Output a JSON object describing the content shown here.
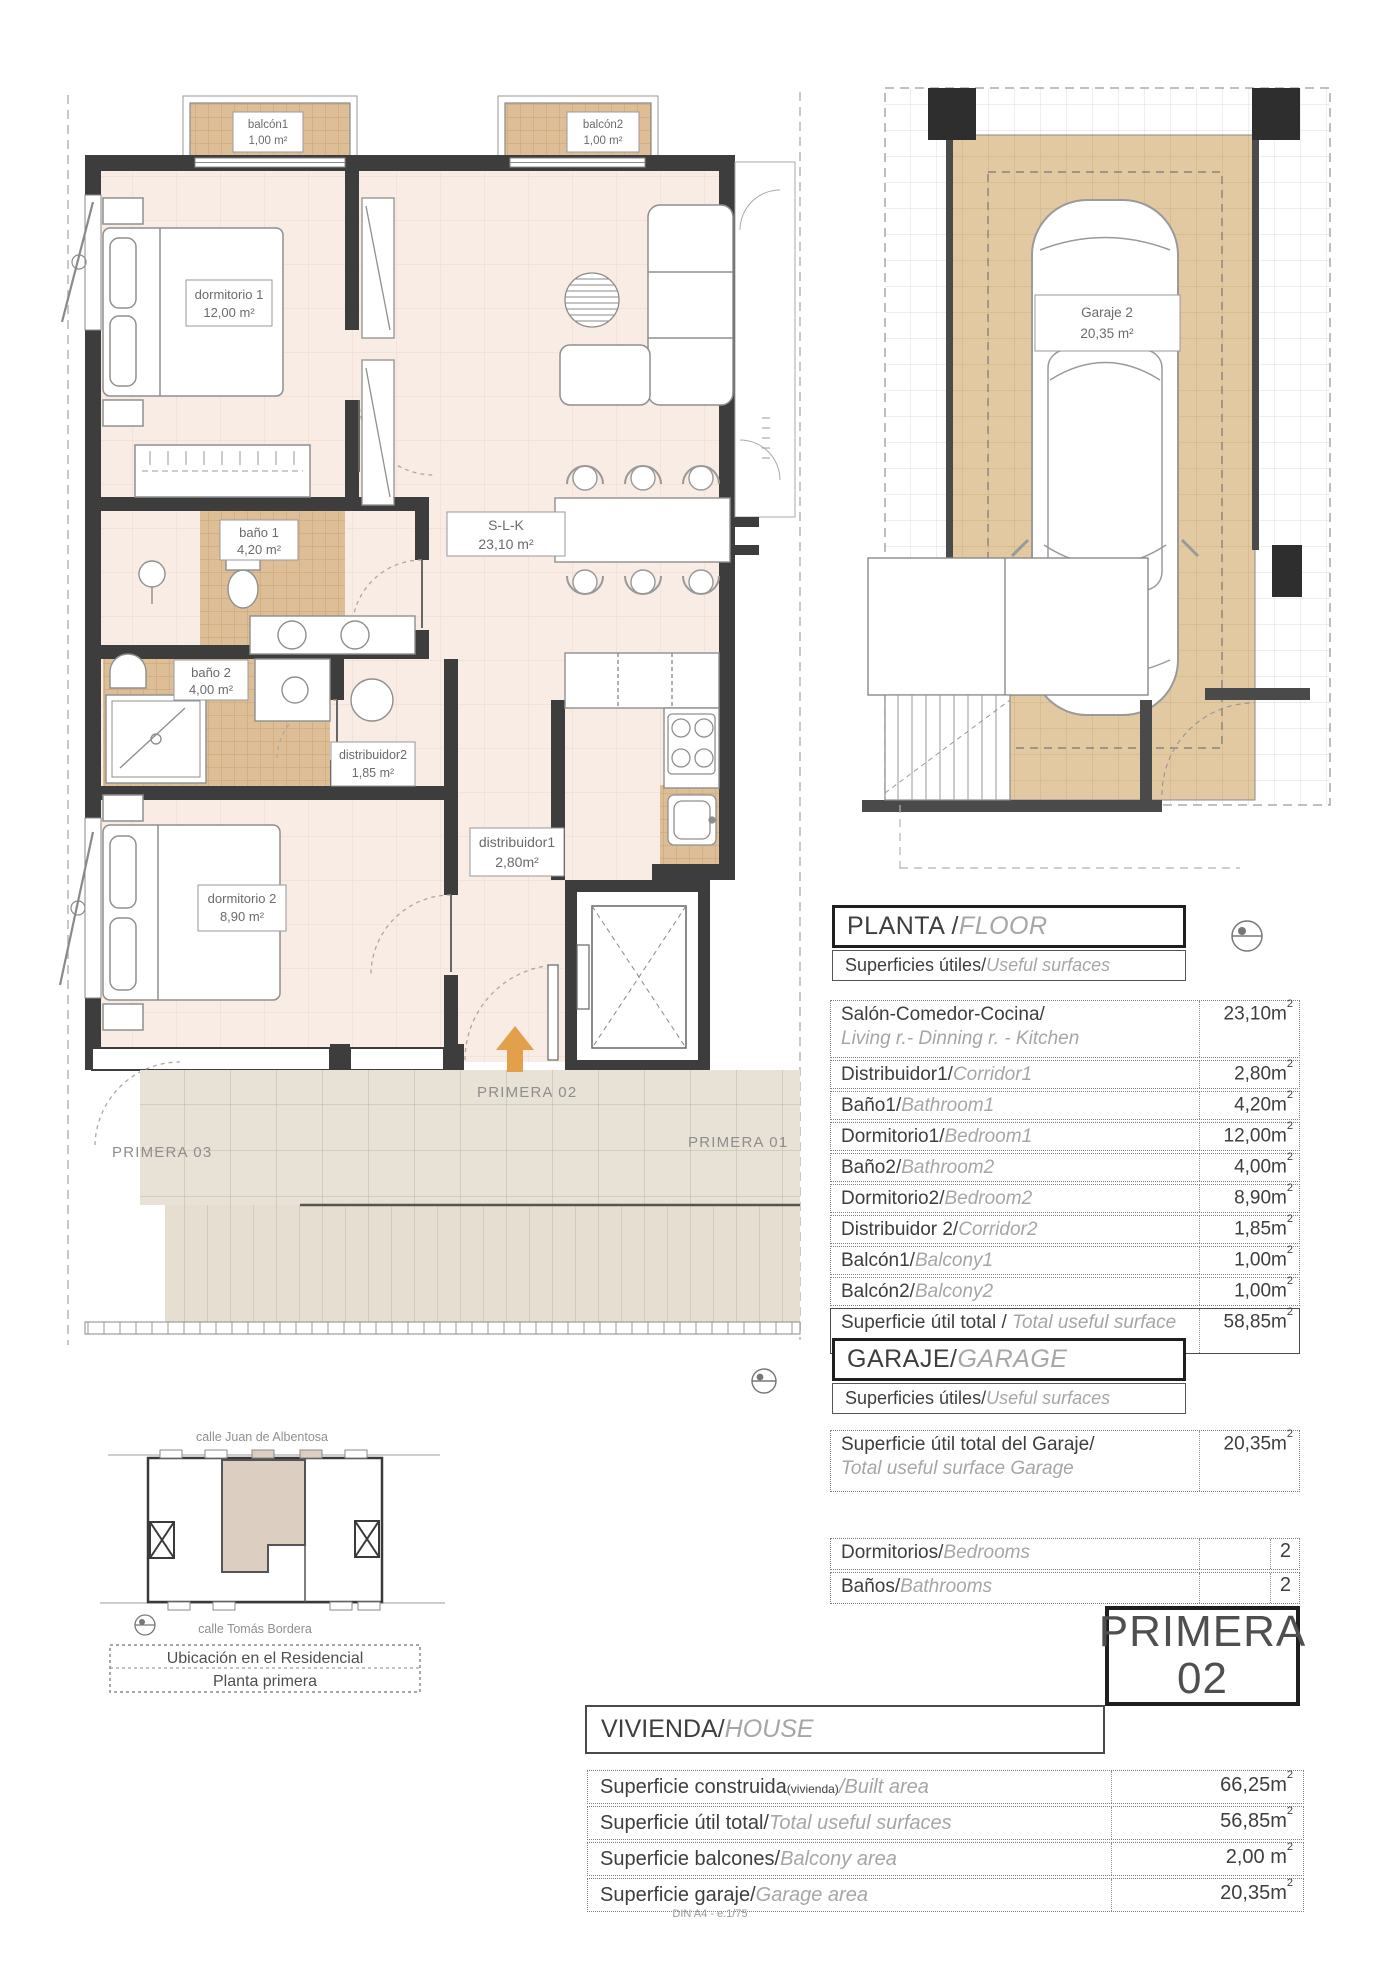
{
  "colors": {
    "accent_orange": "#E2A04A",
    "tile_tan": "#DEBE97",
    "floor_pink": "#F8ECE4",
    "terrace": "#E8E1D5",
    "garage_tan": "#E3C9A1",
    "highlight_unit": "#DCCFC2",
    "wall": "#3D3D3D"
  },
  "floor_plan": {
    "rooms": {
      "balcon1": {
        "name": "balcón1",
        "area": "1,00 m²"
      },
      "balcon2": {
        "name": "balcón2",
        "area": "1,00 m²"
      },
      "dorm1": {
        "name": "dormitorio 1",
        "area": "12,00 m²"
      },
      "bano1": {
        "name": "baño 1",
        "area": "4,20 m²"
      },
      "slk": {
        "name": "S-L-K",
        "area": "23,10 m²"
      },
      "bano2": {
        "name": "baño 2",
        "area": "4,00 m²"
      },
      "distr2": {
        "name": "distribuidor2",
        "area": "1,85 m²"
      },
      "distr1": {
        "name": "distribuidor1",
        "area": "2,80m²"
      },
      "dorm2": {
        "name": "dormitorio 2",
        "area": "8,90 m²"
      }
    },
    "annotations": {
      "primera02": "PRIMERA 02",
      "primera03": "PRIMERA 03",
      "primera01": "PRIMERA 01"
    }
  },
  "garage_plan": {
    "name": "Garaje 2",
    "area": "20,35 m²"
  },
  "floor_table": {
    "title_es": "PLANTA / ",
    "title_en": "FLOOR",
    "subtitle_es": "Superficies útiles/",
    "subtitle_en": "Useful surfaces",
    "rows": [
      {
        "es": "Salón-Comedor-Cocina/",
        "en": "Living r.- Dinning r. - Kitchen",
        "value": "23,10m",
        "sup": "2"
      },
      {
        "es": "Distribuidor1/",
        "en": "Corridor1",
        "value": "2,80m",
        "sup": "2"
      },
      {
        "es": "Baño1/",
        "en": "Bathroom1",
        "value": "4,20m",
        "sup": "2"
      },
      {
        "es": "Dormitorio1/",
        "en": "Bedroom1",
        "value": "12,00m",
        "sup": "2"
      },
      {
        "es": "Baño2/",
        "en": "Bathroom2",
        "value": "4,00m",
        "sup": "2"
      },
      {
        "es": "Dormitorio2/",
        "en": "Bedroom2",
        "value": "8,90m",
        "sup": "2"
      },
      {
        "es": "Distribuidor 2/",
        "en": "Corridor2",
        "value": "1,85m",
        "sup": "2"
      },
      {
        "es": "Balcón1/",
        "en": "Balcony1",
        "value": "1,00m",
        "sup": "2"
      },
      {
        "es": "Balcón2/",
        "en": "Balcony2",
        "value": "1,00m",
        "sup": "2"
      }
    ],
    "total": {
      "es": "Superficie útil total / ",
      "en": "Total useful surface",
      "value": "58,85m",
      "sup": "2"
    }
  },
  "garage_table": {
    "title_es": "GARAJE/",
    "title_en": "GARAGE",
    "subtitle_es": "Superficies útiles/",
    "subtitle_en": "Useful surfaces",
    "row": {
      "es": "Superficie útil total del Garaje/",
      "en": "Total useful surface Garage",
      "value": "20,35m",
      "sup": "2"
    }
  },
  "counts_table": {
    "rows": [
      {
        "es": "Dormitorios/",
        "en": "Bedrooms",
        "value": "2"
      },
      {
        "es": "Baños/",
        "en": "Bathrooms",
        "value": "2"
      }
    ]
  },
  "unit_badge": {
    "line1": "PRIMERA",
    "line2": "02"
  },
  "house_table": {
    "title_es": "VIVIENDA/",
    "title_en": "HOUSE",
    "rows": [
      {
        "es": "Superficie construida",
        "small": "(vivienda)",
        "en": "/Built area",
        "value": "66,25m",
        "sup": "2"
      },
      {
        "es": "Superficie útil total/",
        "en": "Total useful surfaces",
        "value": "56,85m",
        "sup": "2"
      },
      {
        "es": "Superficie balcones/",
        "en": "Balcony area",
        "value": "2,00 m",
        "sup": "2"
      },
      {
        "es": "Superficie garaje/",
        "en": "Garage area",
        "value": "20,35m",
        "sup": "2"
      }
    ]
  },
  "location_plan": {
    "street_top": "calle Juan de Albentosa",
    "street_bottom": "calle Tomás Bordera",
    "caption_line1": "Ubicación en el Residencial",
    "caption_line2": "Planta primera"
  },
  "footer": "DIN A4 - e.1/75"
}
